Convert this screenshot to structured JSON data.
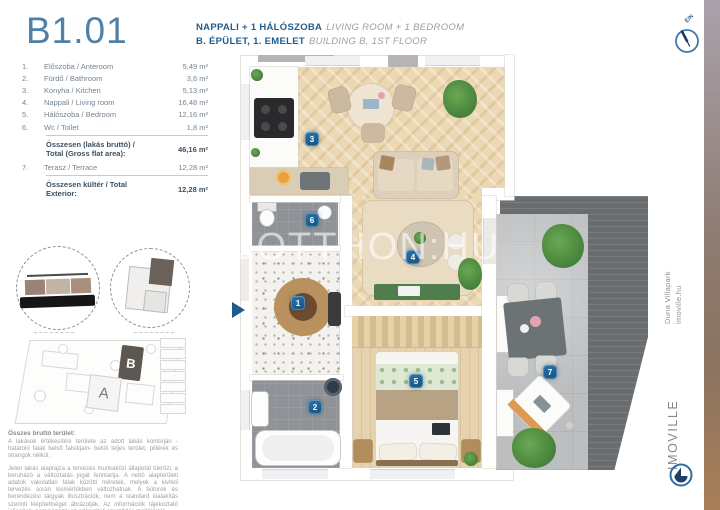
{
  "unit_id": "B1.01",
  "header": {
    "title_hu": "NAPPALI + 1 HÁLÓSZOBA",
    "title_en": "LIVING ROOM + 1 BEDROOM",
    "location_hu": "B. ÉPÜLET, 1. EMELET",
    "location_en": "BUILDING B, 1ST FLOOR"
  },
  "compass": {
    "label": "É/N"
  },
  "room_table": {
    "rows": [
      {
        "num": "1.",
        "name": "Előszoba / Anteroom",
        "area": "5,49 m²"
      },
      {
        "num": "2.",
        "name": "Fürdő / Bathroom",
        "area": "3,6 m²"
      },
      {
        "num": "3.",
        "name": "Konyha / Kitchen",
        "area": "5,13 m²"
      },
      {
        "num": "4.",
        "name": "Nappali / Living room",
        "area": "16,48 m²"
      },
      {
        "num": "5.",
        "name": "Hálószoba / Bedroom",
        "area": "12,16 m²"
      },
      {
        "num": "6.",
        "name": "Wc / Toilet",
        "area": "1,8 m²"
      }
    ],
    "total_flat_label_hu": "Összesen (lakás bruttó) /",
    "total_flat_label_en": "Total (Gross flat area):",
    "total_flat_value": "46,16 m²",
    "terrace_row": {
      "num": "7.",
      "name": "Terasz / Terrace",
      "area": "12,28 m²"
    },
    "total_ext_label": "Összesen kültér / Total Exterior:",
    "total_ext_value": "12,28 m²"
  },
  "site_plan": {
    "building_a": "A",
    "building_b": "B"
  },
  "legal": {
    "heading": "Összes bruttó terület:",
    "para1": "A lakások értékesítési területe az adott lakás kontúrján -határoló falak belső falsíkjain- belüli teljes terület, pillérek és strangok nélkül.",
    "para2": "Jelen lakás alaprajza a tervezés munkaközi állapotát tükrözi, a beruházó a változtatás jogát fenntartja. A nettó alapterületi adatok vakolatlan falak közötti méretek, melyek a kiviteli tervezés során kismértékben változhatnak. A bútorok és berendezési tárgyak illusztrációk, nem a standard kialakítás szerinti kiépítettséget ábrázolják. Az információk tájékoztató jellegűek, nem képezik az adásvételi szerződés mellékletét."
  },
  "plan": {
    "watermark": "UJOTTHON:HU",
    "badges": [
      "1",
      "2",
      "3",
      "4",
      "5",
      "6",
      "7"
    ]
  },
  "sidebar": {
    "project": "Duna Villapark",
    "website": "imoville.hu",
    "brand": "IMOVILLE"
  },
  "colors": {
    "title_blue": "#4e80a8",
    "accent_blue": "#1e5d90",
    "badge_blue": "#1b5f94"
  }
}
